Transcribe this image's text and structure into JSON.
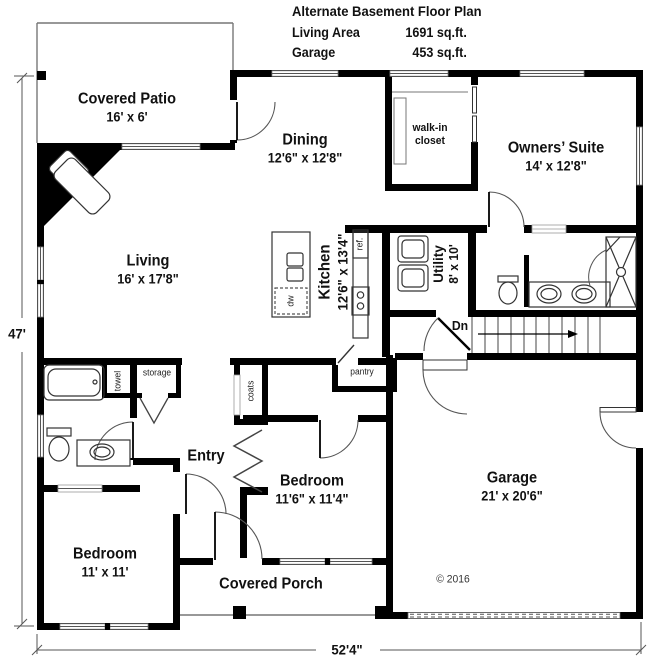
{
  "header": {
    "title": "Alternate Basement Floor Plan",
    "living_area_label": "Living Area",
    "living_area_value": "1691 sq.ft.",
    "garage_label": "Garage",
    "garage_value": "453 sq.ft."
  },
  "rooms": {
    "covered_patio": {
      "name": "Covered Patio",
      "dims": "16' x 6'"
    },
    "dining": {
      "name": "Dining",
      "dims": "12'6\" x 12'8\""
    },
    "walk_in_closet": {
      "line1": "walk-in",
      "line2": "closet"
    },
    "owners_suite": {
      "name": "Owners’ Suite",
      "dims": "14' x 12'8\""
    },
    "living": {
      "name": "Living",
      "dims": "16' x 17'8\""
    },
    "kitchen": {
      "name": "Kitchen",
      "dims": "12'6\" x 13'4\""
    },
    "utility": {
      "name": "Utility",
      "dims": "8' x 10'"
    },
    "entry": {
      "name": "Entry"
    },
    "bedroom_front": {
      "name": "Bedroom",
      "dims": "11'6\" x 11'4\""
    },
    "bedroom_corner": {
      "name": "Bedroom",
      "dims": "11' x 11'"
    },
    "garage": {
      "name": "Garage",
      "dims": "21' x 20'6\""
    },
    "covered_porch": {
      "name": "Covered Porch"
    }
  },
  "fixtures": {
    "towel": "towel",
    "storage": "storage",
    "coats": "coats",
    "pantry": "pantry",
    "ref": "ref.",
    "dw": "dw",
    "dn": "Dn"
  },
  "dimensions": {
    "height": "47'",
    "width": "52'4\""
  },
  "copyright": "© 2016",
  "colors": {
    "wall": "#000000",
    "thin_line": "#777777",
    "background": "#ffffff"
  }
}
